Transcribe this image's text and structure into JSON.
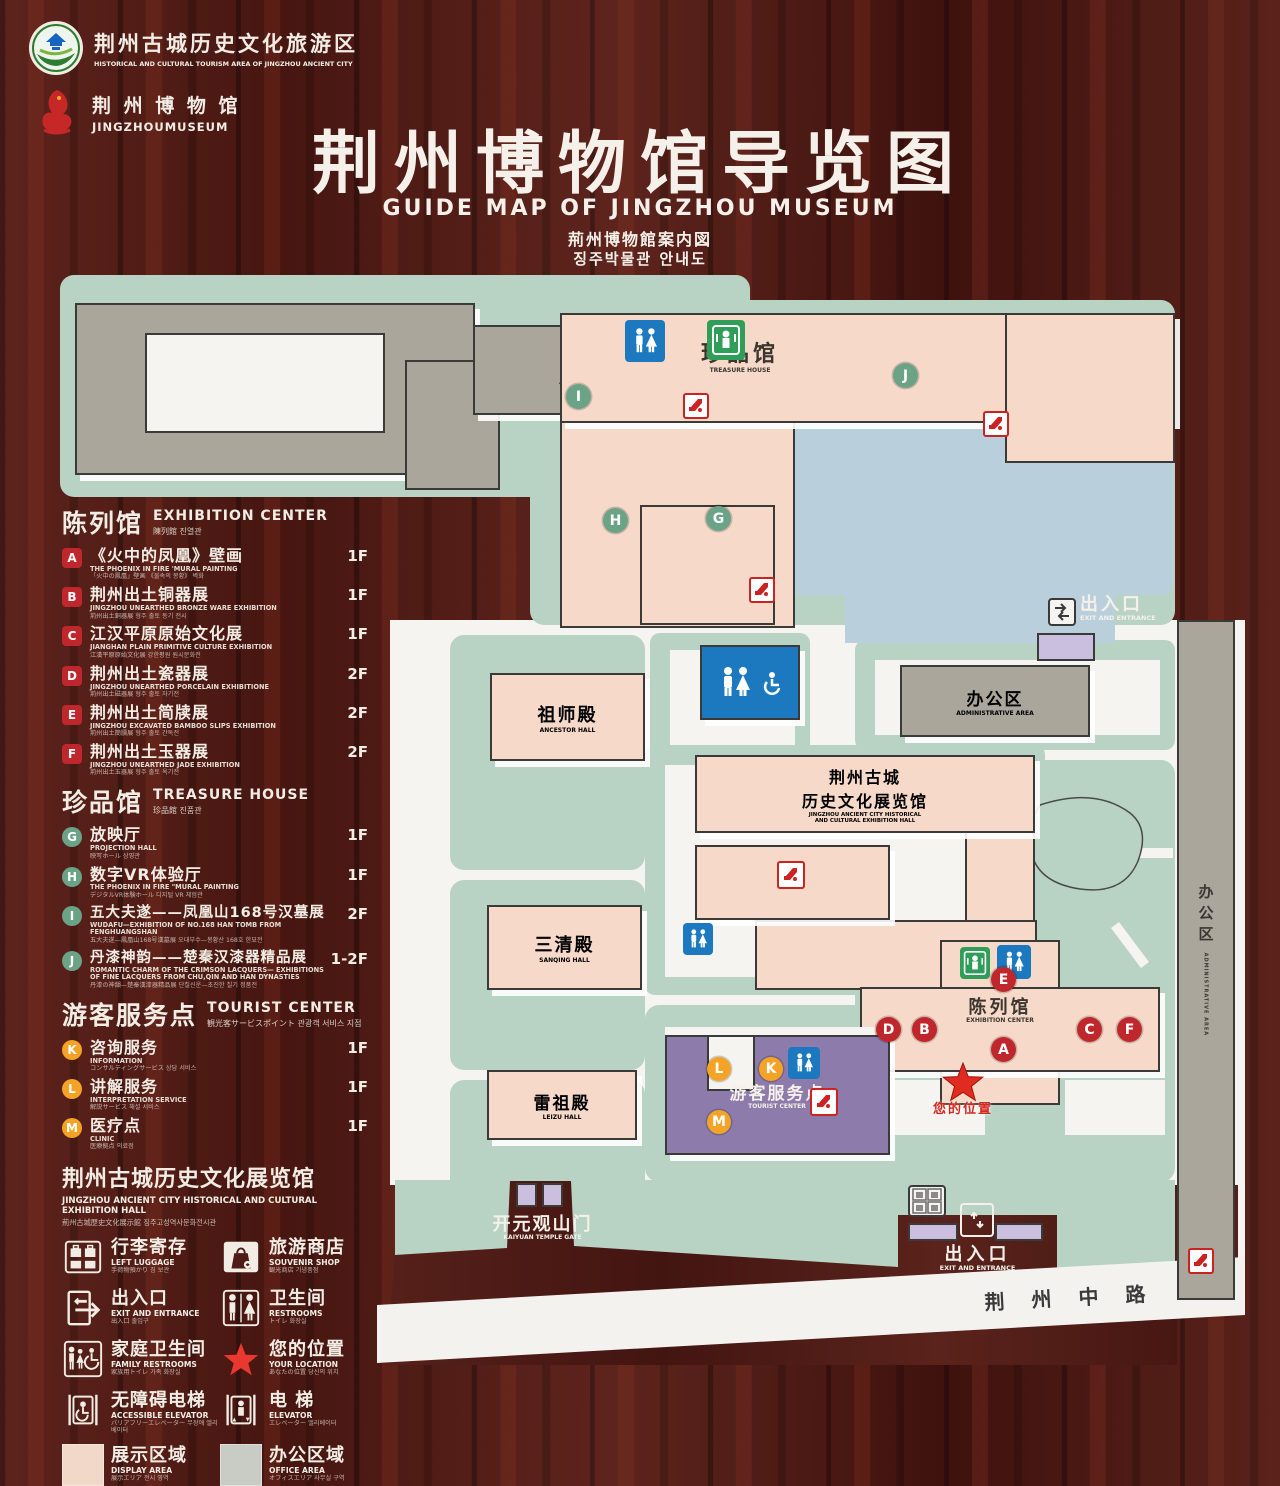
{
  "header": {
    "tourism_logo": {
      "zh": "荆州古城历史文化旅游区",
      "en": "HISTORICAL AND CULTURAL TOURISM AREA OF JINGZHOU ANCIENT CITY"
    },
    "museum_logo": {
      "zh": "荆 州 博 物 馆",
      "en": "JINGZHOUMUSEUM"
    },
    "title_zh": "荆州博物馆导览图",
    "title_en": "GUIDE MAP OF JINGZHOU MUSEUM",
    "title_ja": "荊州博物館案内図",
    "title_ko": "징주박물관 안내도"
  },
  "legend": {
    "exhibition": {
      "title_zh": "陈列馆",
      "title_en": "EXHIBITION CENTER",
      "title_sub": "陳列館  진열관",
      "items": [
        {
          "code": "A",
          "zh": "《火中的凤凰》壁画",
          "en": "THE PHOENIX IN FIRE 'MURAL PAINTING",
          "sub": "「火中の鳳凰」壁画 《불속의 봉황》 벽화",
          "floor": "1F"
        },
        {
          "code": "B",
          "zh": "荆州出土铜器展",
          "en": "JINGZHOU UNEARTHED BRONZE WARE EXHIBITION",
          "sub": "荊州出土銅器展  형주 출토 동기 전시",
          "floor": "1F"
        },
        {
          "code": "C",
          "zh": "江汉平原原始文化展",
          "en": "JIANGHAN PLAIN PRIMITIVE CULTURE EXHIBITION",
          "sub": "江漢平原原始文化展  강한평원 원시문화전",
          "floor": "1F"
        },
        {
          "code": "D",
          "zh": "荆州出土瓷器展",
          "en": "JINGZHOU UNEARTHED PORCELAIN EXHIBITIONE",
          "sub": "荊州出土磁器展  형주 출토 자기전",
          "floor": "2F"
        },
        {
          "code": "E",
          "zh": "荆州出土简牍展",
          "en": "JINGZHOU EXCAVATED BAMBOO SLIPS EXHIBITION",
          "sub": "荊州出土簡牘展  형주 출토 간독전",
          "floor": "2F"
        },
        {
          "code": "F",
          "zh": "荆州出土玉器展",
          "en": "JINGZHOU UNEARTHED JADE EXHIBITION",
          "sub": "荊州出土玉器展  형주 출토 옥기전",
          "floor": "2F"
        }
      ]
    },
    "treasure": {
      "title_zh": "珍品馆",
      "title_en": "TREASURE HOUSE",
      "title_sub": "珍品館  진품관",
      "items": [
        {
          "code": "G",
          "zh": "放映厅",
          "en": "PROJECTION HALL",
          "sub": "映写ホール  상영관",
          "floor": "1F"
        },
        {
          "code": "H",
          "zh": "数字VR体验厅",
          "en": "THE PHOENIX IN FIRE \"MURAL PAINTING",
          "sub": "デジタルVR体験ホール  디지털 VR 체험관",
          "floor": "1F"
        },
        {
          "code": "I",
          "zh": "五大夫遂——凤凰山168号汉墓展",
          "en": "WUDAFU—EXHIBITION OF NO.168 HAN TOMB FROM FENGHUANGSHAN",
          "sub": "五大夫遂—鳳凰山168号漢墓展  오대부수—봉황산 168호 한묘전",
          "floor": "2F"
        },
        {
          "code": "J",
          "zh": "丹漆神韵——楚秦汉漆器精品展",
          "en": "ROMANTIC CHARM OF THE CRIMSON LACQUERS— EXHIBITIONS OF FINE LACQUERS FROM CHU,QIN AND HAN DYNASTIES",
          "sub": "丹漆の神韻—楚秦漢漆器精品展  단칠신운—초진한 칠기 정품전",
          "floor": "1-2F"
        }
      ]
    },
    "tourist": {
      "title_zh": "游客服务点",
      "title_en": "TOURIST CENTER",
      "title_sub": "観光客サービスポイント  관광객 서비스 지점",
      "items": [
        {
          "code": "K",
          "zh": "咨询服务",
          "en": "INFORMATION",
          "sub": "コンサルティングサービス  상담 서비스",
          "floor": "1F"
        },
        {
          "code": "L",
          "zh": "讲解服务",
          "en": "INTERPRETATION SERVICE",
          "sub": "解説サービス  해설 서비스",
          "floor": "1F"
        },
        {
          "code": "M",
          "zh": "医疗点",
          "en": "CLINIC",
          "sub": "医療拠点  의료점",
          "floor": "1F"
        }
      ]
    },
    "history_hall": {
      "zh": "荆州古城历史文化展览馆",
      "en": "JINGZHOU ANCIENT CITY HISTORICAL AND CULTURAL EXHIBITION HALL",
      "sub": "荊州古城歴史文化展示館  징주고성역사문화전시관"
    },
    "facilities": [
      {
        "zh": "行李寄存",
        "en": "LEFT LUGGAGE",
        "sub": "手荷物預かり  짐 보관"
      },
      {
        "zh": "旅游商店",
        "en": "SOUVENIR SHOP",
        "sub": "観光商店  기념품점"
      },
      {
        "zh": "出入口",
        "en": "EXIT AND ENTRANCE",
        "sub": "出入口  출입구"
      },
      {
        "zh": "卫生间",
        "en": "RESTROOMS",
        "sub": "トイレ  화장실"
      },
      {
        "zh": "家庭卫生间",
        "en": "FAMILY RESTROOMS",
        "sub": "家族用トイレ  가족 화장실"
      },
      {
        "zh": "您的位置",
        "en": "YOUR LOCATION",
        "sub": "あなたの位置  당신의 위치"
      },
      {
        "zh": "无障碍电梯",
        "en": "ACCESSIBLE ELEVATOR",
        "sub": "バリアフリーエレベーター  무장애 엘리베이터"
      },
      {
        "zh": "电 梯",
        "en": "ELEVATOR",
        "sub": "エレベーター  엘리베이터"
      },
      {
        "zh": "展示区域",
        "en": "DISPLAY AREA",
        "sub": "展示エリア  전시 영역"
      },
      {
        "zh": "办公区域",
        "en": "OFFICE AREA",
        "sub": "オフィスエリア  사무실 구역"
      }
    ]
  },
  "map": {
    "admin_area_top": {
      "zh": "办公区",
      "en": "ADMINISTRATIVE AREA"
    },
    "treasure_house": {
      "zh": "珍品馆",
      "en": "TREASURE HOUSE"
    },
    "ancestor_hall": {
      "zh": "祖师殿",
      "en": "ANCESTOR HALL"
    },
    "sanqing_hall": {
      "zh": "三清殿",
      "en": "SANQING HALL"
    },
    "leizu_hall": {
      "zh": "雷祖殿",
      "en": "LEIZU HALL"
    },
    "history_hall": {
      "zh1": "荆州古城",
      "zh2": "历史文化展览馆",
      "en1": "JINGZHOU ANCIENT CITY HISTORICAL",
      "en2": "AND CULTURAL EXHIBITION HALL"
    },
    "admin_area_right": {
      "zh": "办公区",
      "en": "ADMINISTRATIVE AREA"
    },
    "admin_area_strip": {
      "zh": "办公区",
      "en": "ADMINISTRATIVE AREA"
    },
    "exhibition_center": {
      "zh": "陈列馆",
      "en": "EXHIBITION CENTER"
    },
    "tourist_center": {
      "zh": "游客服务点",
      "en": "TOURIST CENTER"
    },
    "your_location": {
      "zh": "您的位置"
    },
    "gate": {
      "zh": "开元观山门",
      "en": "KAIYUAN TEMPLE GATE"
    },
    "exit_ne": {
      "zh": "出入口",
      "en": "EXIT AND ENTRANCE"
    },
    "exit_s": {
      "zh": "出入口",
      "en": "EXIT AND ENTRANCE"
    },
    "road": {
      "zh": "荆 州 中 路"
    },
    "markers": {
      "treasure": [
        "I",
        "J",
        "H",
        "G"
      ],
      "exhibition": [
        "E",
        "D",
        "B",
        "A",
        "C",
        "F"
      ],
      "tourist": [
        "L",
        "K",
        "M"
      ]
    }
  },
  "colors": {
    "wood": "#4f1b16",
    "map_green": "#b8d3c4",
    "building_pink": "#f6d9c8",
    "building_gray": "#aaa69c",
    "pond_blue": "#b9cfdb",
    "tourist_purple": "#8d7bab",
    "gate_purple": "#cabfdf",
    "marker_red": "#c0272d",
    "marker_green": "#6ba387",
    "marker_orange": "#f4a326",
    "icon_blue": "#1c79c0",
    "icon_green": "#2f9e58",
    "icon_red": "#cc2222",
    "star_red": "#e02b20"
  }
}
